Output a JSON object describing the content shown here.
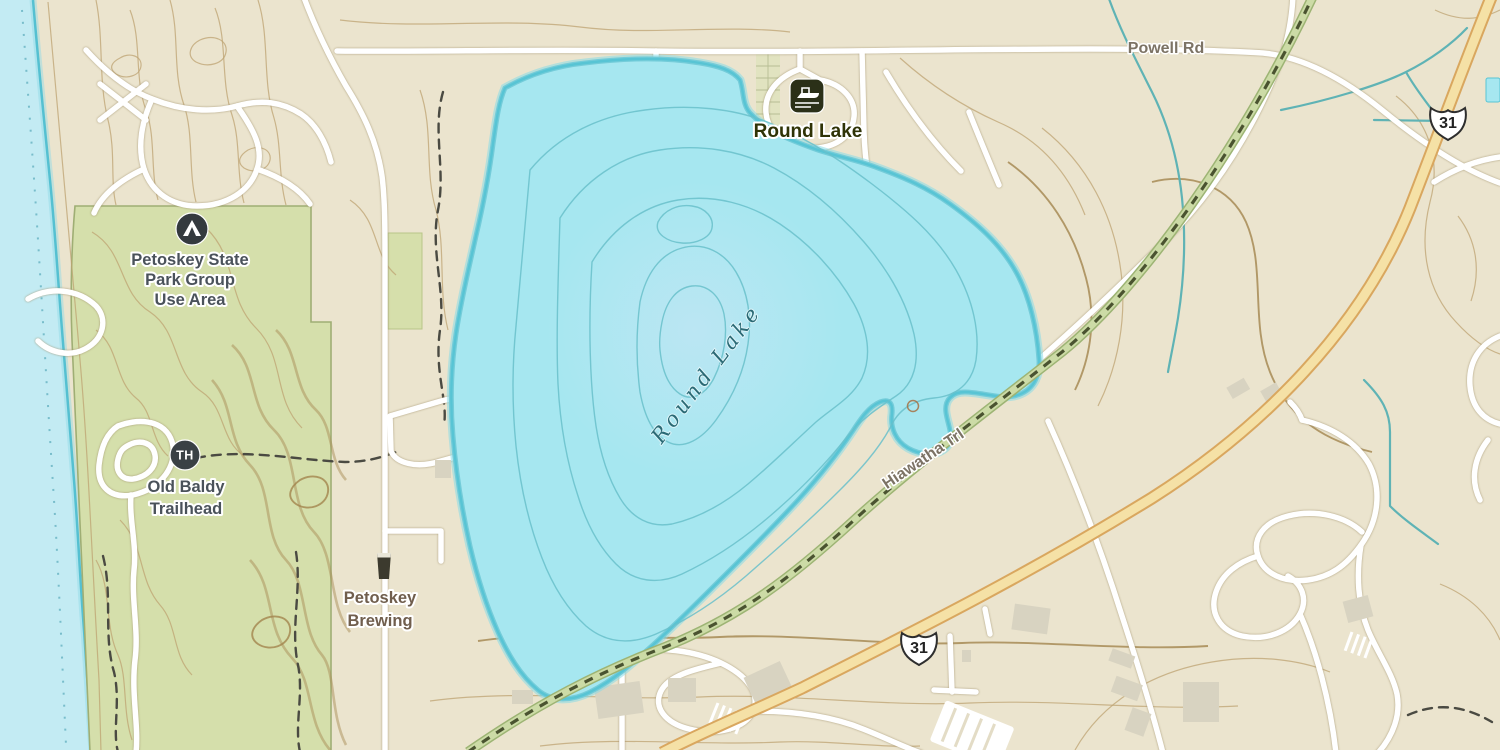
{
  "map": {
    "title": "Topographic map of Round Lake near Petoskey",
    "labels": {
      "powell_rd": "Powell Rd",
      "round_lake_poi": "Round Lake",
      "round_lake_water": "Round Lake",
      "park_group": [
        "Petoskey State",
        "Park Group",
        "Use Area"
      ],
      "old_baldy": [
        "Old Baldy",
        "Trailhead"
      ],
      "brewing": [
        "Petoskey",
        "Brewing"
      ],
      "hiawatha": "Hiawatha Trl",
      "route_31": "31",
      "trailhead_abbr": "TH"
    },
    "icons": {
      "boat_launch": "boat-launch-icon",
      "campground": "campground-icon",
      "trailhead": "trailhead-icon",
      "brewery": "beer-icon",
      "highway_shield": "us-route-shield"
    },
    "colors": {
      "land": "#ebe4ce",
      "water": "#c3ebf3",
      "lake_fill": "#a6e7f0",
      "lake_outline": "#58c4d4",
      "park_green": "#d5dfab",
      "highway_fill": "#f5e1a6",
      "highway_casing": "#d9a75f",
      "road": "#ffffff",
      "rail_trail": "#ccdba6",
      "rail_trail_dash": "#4a5330",
      "contour_brown": "#b99e6d",
      "stream_teal": "#5fb3b5",
      "poi_label": "#2f3306",
      "road_label_gray": "#7c7365",
      "water_label_teal": "#2b6a75",
      "park_label_slate": "#4a525a",
      "brewery_label_brown": "#705e4d"
    }
  }
}
